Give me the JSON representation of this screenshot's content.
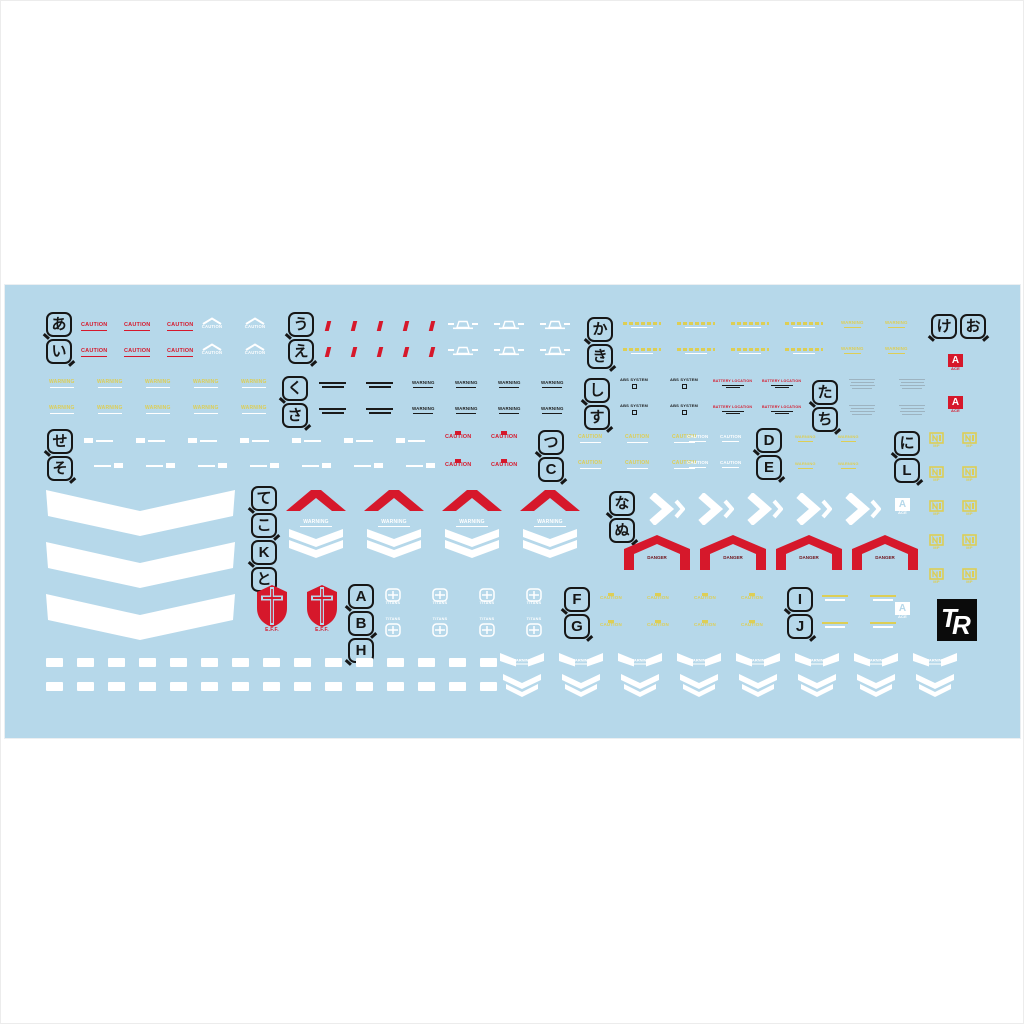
{
  "page": {
    "background": "#ffffff"
  },
  "sheet": {
    "background": "#b6d8ea",
    "x": 4,
    "y": 284,
    "width": 1015,
    "height": 453
  },
  "colors": {
    "red": "#d6182b",
    "dark_red": "#6e1018",
    "yellow": "#ddce55",
    "white": "#ffffff",
    "black": "#1a1a1a",
    "gray": "#9db3c0",
    "logo_black": "#0b0b0b"
  },
  "callouts": [
    {
      "chars": [
        "あ",
        "い"
      ],
      "x": 45,
      "y": 311,
      "dir": "v"
    },
    {
      "chars": [
        "う",
        "え"
      ],
      "x": 287,
      "y": 311,
      "dir": "v"
    },
    {
      "chars": [
        "か",
        "き"
      ],
      "x": 586,
      "y": 316,
      "dir": "v"
    },
    {
      "chars": [
        "け",
        "お"
      ],
      "x": 930,
      "y": 313,
      "dir": "h"
    },
    {
      "chars": [
        "く",
        "さ"
      ],
      "x": 281,
      "y": 375,
      "dir": "v"
    },
    {
      "chars": [
        "し",
        "す"
      ],
      "x": 583,
      "y": 377,
      "dir": "v"
    },
    {
      "chars": [
        "た",
        "ち"
      ],
      "x": 811,
      "y": 379,
      "dir": "v"
    },
    {
      "chars": [
        "せ",
        "そ"
      ],
      "x": 46,
      "y": 428,
      "dir": "v"
    },
    {
      "chars": [
        "つ",
        "C"
      ],
      "x": 537,
      "y": 429,
      "dir": "v"
    },
    {
      "chars": [
        "D",
        "E"
      ],
      "x": 755,
      "y": 427,
      "dir": "v"
    },
    {
      "chars": [
        "に",
        "L"
      ],
      "x": 893,
      "y": 430,
      "dir": "v"
    },
    {
      "chars": [
        "て",
        "こ",
        "K",
        "と"
      ],
      "x": 250,
      "y": 485,
      "dir": "v"
    },
    {
      "chars": [
        "な",
        "ぬ"
      ],
      "x": 608,
      "y": 490,
      "dir": "v"
    },
    {
      "chars": [
        "A",
        "B",
        "H"
      ],
      "x": 347,
      "y": 583,
      "dir": "v"
    },
    {
      "chars": [
        "F",
        "G"
      ],
      "x": 563,
      "y": 586,
      "dir": "v"
    },
    {
      "chars": [
        "I",
        "J"
      ],
      "x": 786,
      "y": 586,
      "dir": "v"
    }
  ],
  "decal_groups": [
    {
      "type": "caution-red",
      "x": 80,
      "y": 322,
      "cols": 3,
      "rows": 2,
      "dx": 43,
      "dy": 26,
      "text": "CAUTION"
    },
    {
      "type": "caution-white-chev",
      "x": 200,
      "y": 316,
      "cols": 2,
      "rows": 2,
      "dx": 43,
      "dy": 26,
      "text": "CAUTION"
    },
    {
      "type": "red-tick",
      "x": 325,
      "y": 320,
      "cols": 5,
      "rows": 2,
      "dx": 26,
      "dy": 26
    },
    {
      "type": "white-grille",
      "x": 447,
      "y": 318,
      "cols": 3,
      "rows": 2,
      "dx": 46,
      "dy": 26
    },
    {
      "type": "yellow-long",
      "x": 622,
      "y": 321,
      "cols": 4,
      "rows": 2,
      "dx": 54,
      "dy": 26
    },
    {
      "type": "yellow-short",
      "x": 840,
      "y": 320,
      "cols": 2,
      "rows": 2,
      "dx": 44,
      "dy": 26,
      "text": "WARNING"
    },
    {
      "type": "ace-badge-red",
      "x": 947,
      "y": 353,
      "cols": 1,
      "rows": 2,
      "dx": 0,
      "dy": 42,
      "text": "A",
      "sub": "ACE"
    },
    {
      "type": "yellow-warning",
      "x": 48,
      "y": 379,
      "cols": 5,
      "rows": 2,
      "dx": 48,
      "dy": 26,
      "text": "WARNING"
    },
    {
      "type": "tiny-2line",
      "x": 318,
      "y": 381,
      "cols": 2,
      "rows": 2,
      "dx": 47,
      "dy": 26
    },
    {
      "type": "black-warning",
      "x": 411,
      "y": 380,
      "cols": 4,
      "rows": 2,
      "dx": 43,
      "dy": 26,
      "text": "WARNING"
    },
    {
      "type": "abs-system",
      "x": 619,
      "y": 377,
      "cols": 2,
      "rows": 2,
      "dx": 50,
      "dy": 26,
      "text": "ABS SYSTEM"
    },
    {
      "type": "battery",
      "x": 712,
      "y": 379,
      "cols": 2,
      "rows": 2,
      "dx": 49,
      "dy": 26,
      "text": "BATTERY LOCATION"
    },
    {
      "type": "gray-block",
      "x": 848,
      "y": 378,
      "cols": 2,
      "rows": 2,
      "dx": 50,
      "dy": 26
    },
    {
      "type": "white-block-text",
      "x": 83,
      "y": 437,
      "cols": 7,
      "rows": 1,
      "dx": 52
    },
    {
      "type": "white-text-block",
      "x": 93,
      "y": 462,
      "cols": 7,
      "rows": 1,
      "dx": 52
    },
    {
      "type": "caution-red-block",
      "x": 444,
      "y": 430,
      "cols": 2,
      "rows": 2,
      "dx": 46,
      "dy": 28,
      "text": "CAUTION"
    },
    {
      "type": "caution-yellow",
      "x": 577,
      "y": 434,
      "cols": 3,
      "rows": 2,
      "dx": 47,
      "dy": 26,
      "text": "CAUTION"
    },
    {
      "type": "caution-white",
      "x": 686,
      "y": 434,
      "cols": 2,
      "rows": 2,
      "dx": 33,
      "dy": 26,
      "text": "CAUTION"
    },
    {
      "type": "warning-yellow-small",
      "x": 794,
      "y": 434,
      "cols": 2,
      "rows": 2,
      "dx": 43,
      "dy": 27,
      "text": "WARNING"
    },
    {
      "type": "un-mp",
      "x": 928,
      "y": 431,
      "cols": 2,
      "rows": 5,
      "dx": 33,
      "dy": 34,
      "text": "MP"
    },
    {
      "type": "big-chevron",
      "x": 42,
      "y": 489,
      "cols": 1,
      "rows": 3,
      "dx": 0,
      "dy": 52
    },
    {
      "type": "red-chevron",
      "x": 284,
      "y": 487,
      "cols": 4,
      "rows": 1,
      "dx": 78
    },
    {
      "type": "warning-shield",
      "x": 286,
      "y": 519,
      "cols": 4,
      "rows": 1,
      "dx": 78,
      "text": "WARNING"
    },
    {
      "type": "white-arrow-r",
      "x": 646,
      "y": 492,
      "cols": 5,
      "rows": 1,
      "dx": 49
    },
    {
      "type": "ace-badge-white",
      "x": 894,
      "y": 497,
      "cols": 1,
      "rows": 1,
      "text": "A",
      "sub": "ACE"
    },
    {
      "type": "danger-arrow",
      "x": 621,
      "y": 533,
      "cols": 4,
      "rows": 1,
      "dx": 76,
      "text": "DANGER"
    },
    {
      "type": "eff-shield",
      "x": 254,
      "y": 583,
      "cols": 2,
      "rows": 1,
      "dx": 50,
      "text": "E.F.F."
    },
    {
      "type": "titans-top",
      "x": 384,
      "y": 587,
      "cols": 4,
      "rows": 1,
      "dx": 47,
      "text": "TITANS"
    },
    {
      "type": "titans-bottom",
      "x": 384,
      "y": 617,
      "cols": 4,
      "rows": 1,
      "dx": 47,
      "text": "TITANS"
    },
    {
      "type": "caution-yellow-block",
      "x": 599,
      "y": 592,
      "cols": 4,
      "rows": 2,
      "dx": 47,
      "dy": 27,
      "text": "CAUTION"
    },
    {
      "type": "yellow-white-2l",
      "x": 821,
      "y": 594,
      "cols": 2,
      "rows": 2,
      "dx": 48,
      "dy": 27
    },
    {
      "type": "ace-badge-white",
      "x": 894,
      "y": 601,
      "cols": 1,
      "rows": 1,
      "text": "A",
      "sub": "ACE"
    },
    {
      "type": "tr-logo",
      "x": 936,
      "y": 598,
      "cols": 1,
      "rows": 1,
      "text": "TR"
    },
    {
      "type": "white-dash",
      "x": 45,
      "y": 657,
      "cols": 15,
      "rows": 2,
      "dx": 31,
      "dy": 24
    },
    {
      "type": "warning-wing",
      "x": 498,
      "y": 652,
      "cols": 8,
      "rows": 1,
      "dx": 59,
      "text": "WARNING"
    }
  ]
}
